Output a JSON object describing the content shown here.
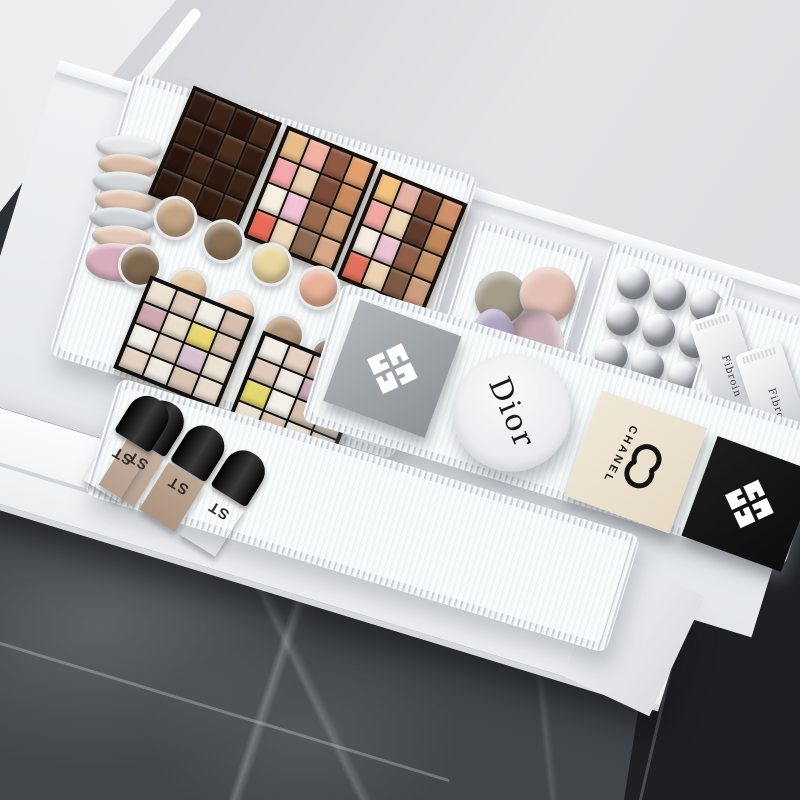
{
  "brand": {
    "name": "EVA"
  },
  "overlay_box": {
    "line1": "Combination E:",
    "line2": "Large*1+Long*2",
    "line3": "Small size*3"
  },
  "callouts": {
    "large_label": "Large size*1",
    "small_label": "Small size*3",
    "long_label": "Long style*2"
  },
  "products": {
    "dior": "Dior",
    "chanel": "CHANEL",
    "st": "ST",
    "fibroin": "Fibroin"
  },
  "colors": {
    "logo_text": "#0c0c0c",
    "logo_outline": "#ffffff",
    "logo_bars": [
      "#f08a3c",
      "#e85c3a",
      "#d93a50",
      "#c72562",
      "#b01e56"
    ],
    "overlay_bg": "#080808",
    "overlay_text": "#ffffff",
    "bubble_bg": "#ffffff",
    "bubble_text": "#0d0d0d",
    "counter_gray": "#d4d7da",
    "drawer_white": "#f4f6f7",
    "acrylic": "#eef1f3",
    "marble_dark": "#1d1f23"
  },
  "photo": {
    "palette_dark": [
      "#301b12",
      "#3c2315",
      "#2a160e",
      "#452a19",
      "#351e12",
      "#2c1810",
      "#4a2d1b",
      "#331d11",
      "#27140d",
      "#3f2617",
      "#2f1a10",
      "#3a2214",
      "#2c170e",
      "#44291a",
      "#321c11",
      "#3d2516"
    ],
    "palette_warm_a": [
      "#e7bd8a",
      "#f2b2a2",
      "#8e5a42",
      "#e2a070",
      "#f2a8ac",
      "#ecd2b2",
      "#7c4a38",
      "#c88a5e",
      "#f6f0e2",
      "#f2c2d6",
      "#9a6a4e",
      "#cc9a74",
      "#ea6a58",
      "#f0d8bc",
      "#8a6a52",
      "#d8a888"
    ],
    "palette_warm_b": [
      "#f2c27e",
      "#e6b2a4",
      "#7a4a36",
      "#d0906a",
      "#f0a8a0",
      "#eed8b8",
      "#5e3a2c",
      "#c08858",
      "#f4ece0",
      "#eec4d4",
      "#8e5e46",
      "#c49268",
      "#e2705c",
      "#ecd4b4",
      "#7e5a44",
      "#cc9e7c"
    ],
    "palette_pale_a": [
      "#eee3d3",
      "#e0ccbc",
      "#f2eee6",
      "#d6beae",
      "#cfa8b2",
      "#eadfcc",
      "#e8d772",
      "#dcc6b4",
      "#f4f1ea",
      "#e2cfc0",
      "#d9c2d0",
      "#ece2d2",
      "#e6d2c0",
      "#f0ebe2",
      "#dac4b2",
      "#e8dcca"
    ],
    "palette_pale_b": [
      "#f2eee6",
      "#e6d2c0",
      "#d9c2b2",
      "#eee3d3",
      "#e0ccbc",
      "#f0ebe2",
      "#d2aeb8",
      "#eadfcc",
      "#e4d86e",
      "#f4f1ea",
      "#dcc6b4",
      "#e2cfc0",
      "#ece2d2",
      "#d8c2b0",
      "#eee6d6",
      "#e6d8c6"
    ],
    "compact_row_1": [
      "#c2a584",
      "#8a7158",
      "#e8d6a2",
      "#e8b298",
      "#d9bdb2",
      "#cdc2b4"
    ],
    "compact_row_2": [
      "#7e6850",
      "#e2c39c",
      "#efd2ba",
      "#b29478",
      "#6d593f",
      "#e0b4a0"
    ],
    "jar_stack": [
      "#e4e6e9",
      "#d9bca8",
      "#d3d7da",
      "#dfc2ae",
      "#cdd2d6",
      "#e3c9b7",
      "#d6aebe"
    ],
    "sponges": [
      "#a59c8b",
      "#e4c1b6",
      "#ccb0b8",
      "#b3a6c5"
    ],
    "lipstick_tubes": [
      "#d8dbdf",
      "#cfd3d8",
      "#d8dbdf",
      "#d3d6da",
      "#dadde1",
      "#cdd1d6",
      "#d6d9dd",
      "#d1d5d9",
      "#dbdee2"
    ]
  }
}
